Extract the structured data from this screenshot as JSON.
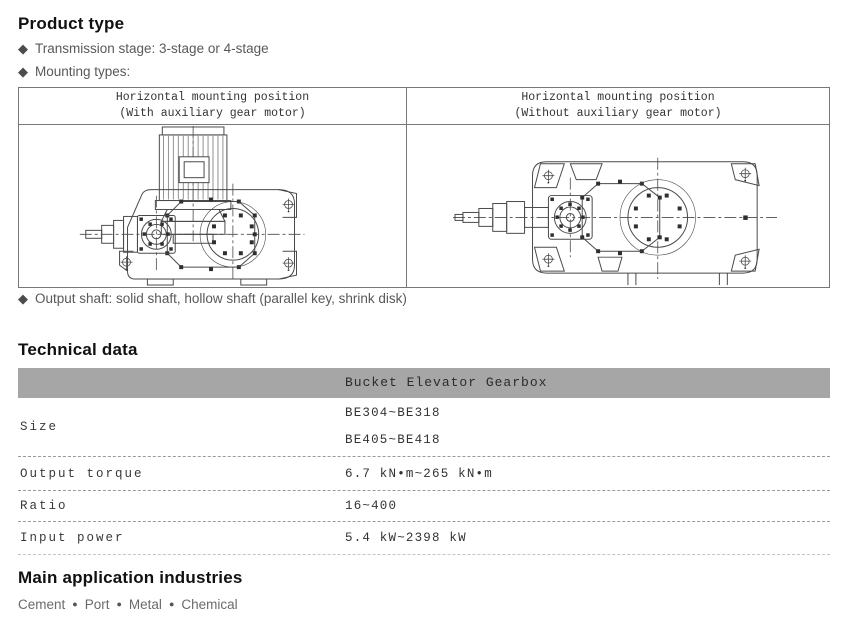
{
  "icons": {
    "diamond": "◆",
    "dot_separator": "●"
  },
  "colors": {
    "heading_text": "#111111",
    "body_text": "#595959",
    "table_border": "#777777",
    "tech_header_bg": "#a6a6a6",
    "mono_text": "#333333",
    "dashed_line": "#9a9a9a",
    "drawing_line": "#4a4a4a"
  },
  "product_type": {
    "title": "Product type",
    "bullets": [
      "Transmission stage: 3-stage or 4-stage",
      "Mounting types:"
    ],
    "output_shaft_bullet": "Output shaft: solid shaft, hollow shaft (parallel key, shrink disk)",
    "mounting_table": {
      "columns": [
        {
          "title_line1": "Horizontal mounting position",
          "title_line2": "(With auxiliary gear motor)",
          "drawing": "gearbox-with-auxiliary-gear-motor"
        },
        {
          "title_line1": "Horizontal mounting position",
          "title_line2": "(Without auxiliary gear motor)",
          "drawing": "gearbox-without-auxiliary-gear-motor"
        }
      ]
    }
  },
  "technical_data": {
    "title": "Technical data",
    "product_header": "Bucket Elevator Gearbox",
    "rows": [
      {
        "label": "Size",
        "values": [
          "BE304~BE318",
          "BE405~BE418"
        ]
      },
      {
        "label": "Output torque",
        "values": [
          "6.7 kN•m~265 kN•m"
        ]
      },
      {
        "label": "Ratio",
        "values": [
          "16~400"
        ]
      },
      {
        "label": "Input power",
        "values": [
          "5.4 kW~2398 kW"
        ]
      }
    ]
  },
  "applications": {
    "title": "Main application industries",
    "industries": [
      "Cement",
      "Port",
      "Metal",
      "Chemical"
    ]
  }
}
